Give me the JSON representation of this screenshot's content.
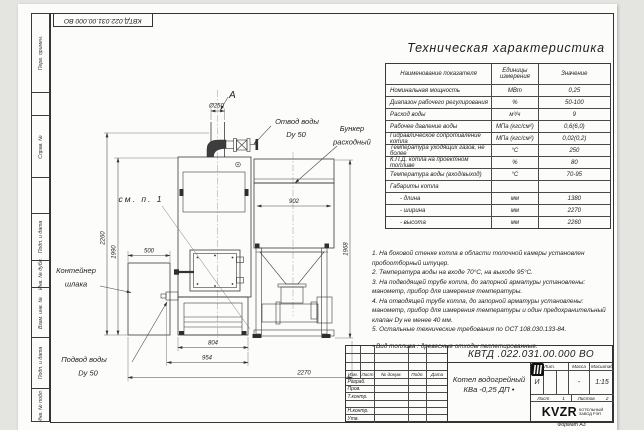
{
  "page": {
    "doc_number_top": "КВТД.022.031.00.000 ВО",
    "format_note": "Формат А3"
  },
  "frame_labels": {
    "perv_primen": "Перв. примен.",
    "sprav_no": "Справ. №",
    "podp_data_1": "Подп. и дата",
    "inv_dubl": "Инв. № дубл.",
    "vzam_inv": "Взам. инв. №",
    "podp_data_2": "Подп. и дата",
    "inv_podl": "Инв. № подл."
  },
  "table": {
    "title": "Техническая характеристика",
    "headers": {
      "name": "Наименование показателя",
      "units": "Единицы измерения",
      "value": "Значение"
    },
    "rows": [
      {
        "name": "Номинальная мощность",
        "units": "МВт",
        "value": "0,25"
      },
      {
        "name": "Диапазон рабочего регулирования",
        "units": "%",
        "value": "50-100"
      },
      {
        "name": "Расход воды",
        "units": "м³/ч",
        "value": "9"
      },
      {
        "name": "Рабочее давление воды",
        "units": "МПа (кгс/см²)",
        "value": "0,6(6,0)"
      },
      {
        "name": "Гидравлическое сопротивление котла",
        "units": "МПа (кгс/см²)",
        "value": "0,02(0,2)"
      },
      {
        "name": "Температура уходящих газов, не более",
        "units": "°С",
        "value": "250"
      },
      {
        "name": "К.П.Д. котла на проектном топливе",
        "units": "%",
        "value": "80"
      },
      {
        "name": "Температура воды (вход/выход)",
        "units": "°С",
        "value": "70-95"
      },
      {
        "name": "Габариты котла",
        "units": "",
        "value": ""
      },
      {
        "name": "- длина",
        "units": "мм",
        "value": "1380"
      },
      {
        "name": "- ширина",
        "units": "мм",
        "value": "2270"
      },
      {
        "name": "- высота",
        "units": "мм",
        "value": "2260"
      }
    ]
  },
  "notes": {
    "lines": [
      "1. На боковой стенке котла в области топочной камеры установлен",
      "пробоотборный штуцер.",
      "2. Температура воды на входе 70°С, на выходе 95°С.",
      "3. На подводящей трубе котла, до запорной арматуры установлены:",
      "манометр, прибор для измерения температуры.",
      "4. На отводящей трубе котла, до запорной арматуры установлены:",
      "манометр, прибор для измерения температуры и один предохранительный",
      "клапан Dу не менее 40 мм.",
      "5. Остальные технические требования по ОСТ 108.030.133-84."
    ],
    "fuel": "• Вид топлива : древесные отходы пеллетированные."
  },
  "drawing": {
    "view_label": "А",
    "labels": {
      "otvod_1": "Отвод воды",
      "otvod_2": "Dy 50",
      "bunker_1": "Бункер",
      "bunker_2": "расходный",
      "sm_p1": "см. п. 1",
      "container_1": "Контейнер",
      "container_2": "шлака",
      "podvod_1": "Подвод воды",
      "podvod_2": "Dy 50"
    },
    "dims": {
      "d250": "Ø250",
      "w902": "902",
      "h2260": "2260",
      "h1990": "1990",
      "h1968": "1968",
      "w500": "500",
      "w804": "804",
      "w954": "954",
      "w2270": "2270"
    }
  },
  "title_block": {
    "doc_number": "КВТД .022.031.00.000 ВО",
    "name_line1": "Котел водогрейный",
    "name_line2": "КВа -0,25 ДП •",
    "header": {
      "izm": "Изм.",
      "list": "Лист",
      "dokum": "№ докум.",
      "podp": "Подп.",
      "data": "Дата"
    },
    "rows": {
      "r1": "Разраб.",
      "r2": "Пров.",
      "r3": "Т.контр.",
      "r4": "",
      "r5": "Н.контр.",
      "r6": "Утв."
    },
    "lit_label": "Лит.",
    "massa_label": "Масса",
    "masshtab_label": "Масштаб",
    "lit_value": "И",
    "massa_value": "-",
    "masshtab_value": "1:15",
    "list_label": "Лист",
    "list_value": "1",
    "listov_label": "Листов",
    "listov_value": "2",
    "logo_text": "KVZR",
    "logo_sub1": "КОТЕЛЬНЫЙ",
    "logo_sub2": "ЗАВОД РЭП",
    "format": "Формат А3"
  }
}
